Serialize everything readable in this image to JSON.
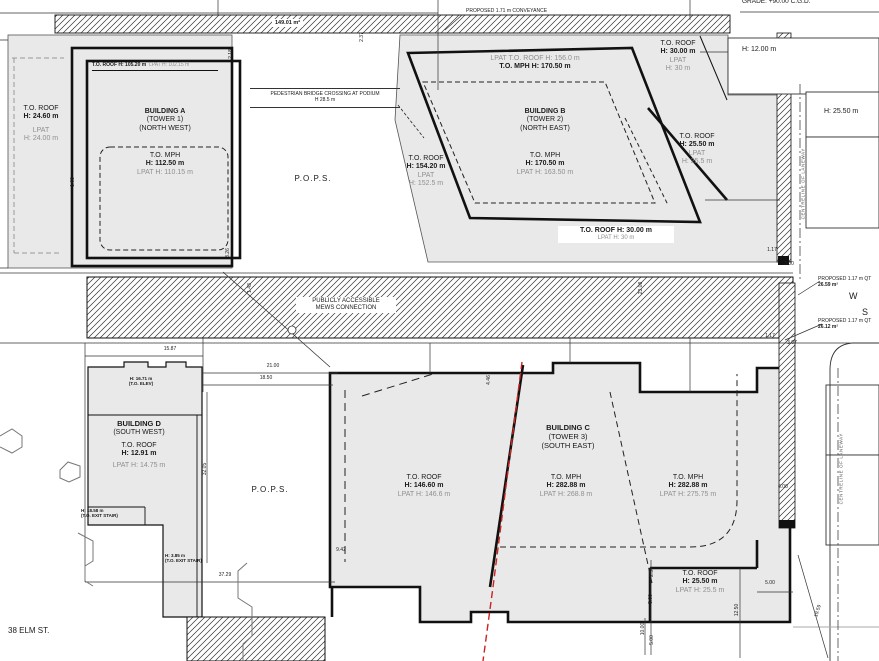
{
  "drawing": {
    "grade_note": "GRADE: +90.00 C.G.D.",
    "street_label": "38 ELM ST.",
    "pops_north": "P.O.P.S.",
    "pops_south": "P.O.P.S.",
    "mews_line1": "PUBLICLY ACCESSIBLE",
    "mews_line2": "MEWS CONNECTION",
    "conveyance_top": {
      "label": "PROPOSED 1.71 m CONVEYANCE",
      "area": "149.01 m²"
    },
    "bridge": {
      "line1": "PEDESTRIAN BRIDGE CROSSING AT PODIUM",
      "line2": "H 28.5 m"
    },
    "laneway_north": "CENTRELINE OF LANEWAY",
    "laneway_south": "CENTRELINE OF LANEWAY",
    "conveyance_right_1": {
      "label": "PROPOSED 1.17 m QT",
      "area": "26.59 m²"
    },
    "conveyance_right_2": {
      "label": "PROPOSED 1.17 m QT",
      "area": "26.12 m²"
    },
    "street_letters": {
      "w": "W",
      "s": "S"
    },
    "neighbor_heights": {
      "h12": "H: 12.00 m",
      "h2550": "H: 25.50 m"
    }
  },
  "building_a": {
    "header_roof": "T.O. ROOF H: 105.20 m",
    "header_lpat": "LPAT H: 102.15 m",
    "name1": "BUILDING A",
    "name2": "(TOWER 1)",
    "name3": "(NORTH WEST)",
    "mph_title": "T.O. MPH",
    "mph_h": "H: 112.50 m",
    "mph_lpat": "LPAT H: 110.15 m",
    "parcel_roof": "T.O. ROOF",
    "parcel_h": "H: 24.60 m",
    "parcel_lpat": "LPAT",
    "parcel_lpat_h": "H: 24.00 m"
  },
  "building_b": {
    "top_lpat": "LPAT T.O. ROOF H: 156.0 m",
    "top_mph": "T.O. MPH H: 170.50 m",
    "name1": "BUILDING B",
    "name2": "(TOWER 2)",
    "name3": "(NORTH EAST)",
    "mph_title": "T.O. MPH",
    "mph_h": "H: 170.50 m",
    "mph_lpat": "LPAT H: 163.50 m",
    "west_roof": "T.O. ROOF",
    "west_h": "H: 154.20 m",
    "west_lpat": "LPAT",
    "west_lpat_h": "H: 152.5 m",
    "ne_roof": "T.O. ROOF",
    "ne_h": "H: 30.00 m",
    "ne_lpat": "LPAT",
    "ne_lpat_h": "H: 30 m",
    "east_roof": "T.O. ROOF",
    "east_h": "H: 25.50 m",
    "east_lpat": "LPAT",
    "east_lpat_h": "H: 25.5 m",
    "south_roof": "T.O. ROOF H: 30.00 m",
    "south_lpat": "LPAT H: 30 m"
  },
  "building_c": {
    "name1": "BUILDING C",
    "name2": "(TOWER 3)",
    "name3": "(SOUTH EAST)",
    "west_roof": "T.O. ROOF",
    "west_h": "H: 146.60 m",
    "west_lpat": "LPAT H: 146.6 m",
    "mid_mph": "T.O. MPH",
    "mid_h": "H: 282.88 m",
    "mid_lpat": "LPAT H: 268.8 m",
    "east_mph": "T.O. MPH",
    "east_h": "H: 282.88 m",
    "east_lpat": "LPAT H: 275.75 m",
    "se_roof": "T.O. ROOF",
    "se_h": "H: 25.50 m",
    "se_lpat": "LPAT H: 25.5 m"
  },
  "building_d": {
    "name1": "BUILDING D",
    "name2": "(SOUTH WEST)",
    "roof": "T.O. ROOF",
    "h": "H: 12.91 m",
    "lpat": "LPAT H: 14.75 m",
    "elev_note1": "H: 16.71 m",
    "elev_note2": "(T.O. ELEV)",
    "stair1_note1": "H: 18.58 m",
    "stair1_note2": "(T.O. EXIT STAIR)",
    "stair2_note1": "H: 3.85 m",
    "stair2_note2": "(T.O. EXIT STAIR)"
  },
  "dimensions": [
    {
      "t": "2.37",
      "x": 362,
      "y": 38,
      "r": -90
    },
    {
      "t": "2.18",
      "x": 231,
      "y": 55,
      "r": -90
    },
    {
      "t": "1.68",
      "x": 73,
      "y": 183,
      "r": -90
    },
    {
      "t": "3.26",
      "x": 228,
      "y": 254,
      "r": -90
    },
    {
      "t": "1.43",
      "x": 250,
      "y": 289,
      "r": -90
    },
    {
      "t": "23.08",
      "x": 641,
      "y": 289,
      "r": -90
    },
    {
      "t": "15.87",
      "x": 170,
      "y": 350,
      "r": 0
    },
    {
      "t": "21.00",
      "x": 273,
      "y": 367,
      "r": 0
    },
    {
      "t": "18.50",
      "x": 266,
      "y": 379,
      "r": 0
    },
    {
      "t": "32.05",
      "x": 205,
      "y": 470,
      "r": -90
    },
    {
      "t": "37.29",
      "x": 225,
      "y": 576,
      "r": 0
    },
    {
      "t": "4.46",
      "x": 489,
      "y": 381,
      "r": -90
    },
    {
      "t": "9.42",
      "x": 341,
      "y": 551,
      "r": 0
    },
    {
      "t": "2.50",
      "x": 652,
      "y": 573,
      "r": -90
    },
    {
      "t": "5.00",
      "x": 770,
      "y": 584,
      "r": 0
    },
    {
      "t": "5.00",
      "x": 651,
      "y": 600,
      "r": -90
    },
    {
      "t": "12.50",
      "x": 737,
      "y": 611,
      "r": -90
    },
    {
      "t": "10.00",
      "x": 643,
      "y": 630,
      "r": -90
    },
    {
      "t": "5.00",
      "x": 652,
      "y": 641,
      "r": -90
    },
    {
      "t": "19.59",
      "x": 818,
      "y": 612,
      "r": -72
    },
    {
      "t": "1.17",
      "x": 772,
      "y": 251,
      "r": 0
    },
    {
      "t": "3.00",
      "x": 789,
      "y": 265,
      "r": 0
    },
    {
      "t": "3.07",
      "x": 792,
      "y": 344,
      "r": 0
    },
    {
      "t": "1.17",
      "x": 770,
      "y": 337,
      "r": 0
    },
    {
      "t": "6.00",
      "x": 783,
      "y": 488,
      "r": 0
    }
  ],
  "colors": {
    "parcel_fill": "#e9e9e9",
    "line": "#111111",
    "muted_text": "#8f8f8f",
    "red_line": "#cc2222"
  }
}
